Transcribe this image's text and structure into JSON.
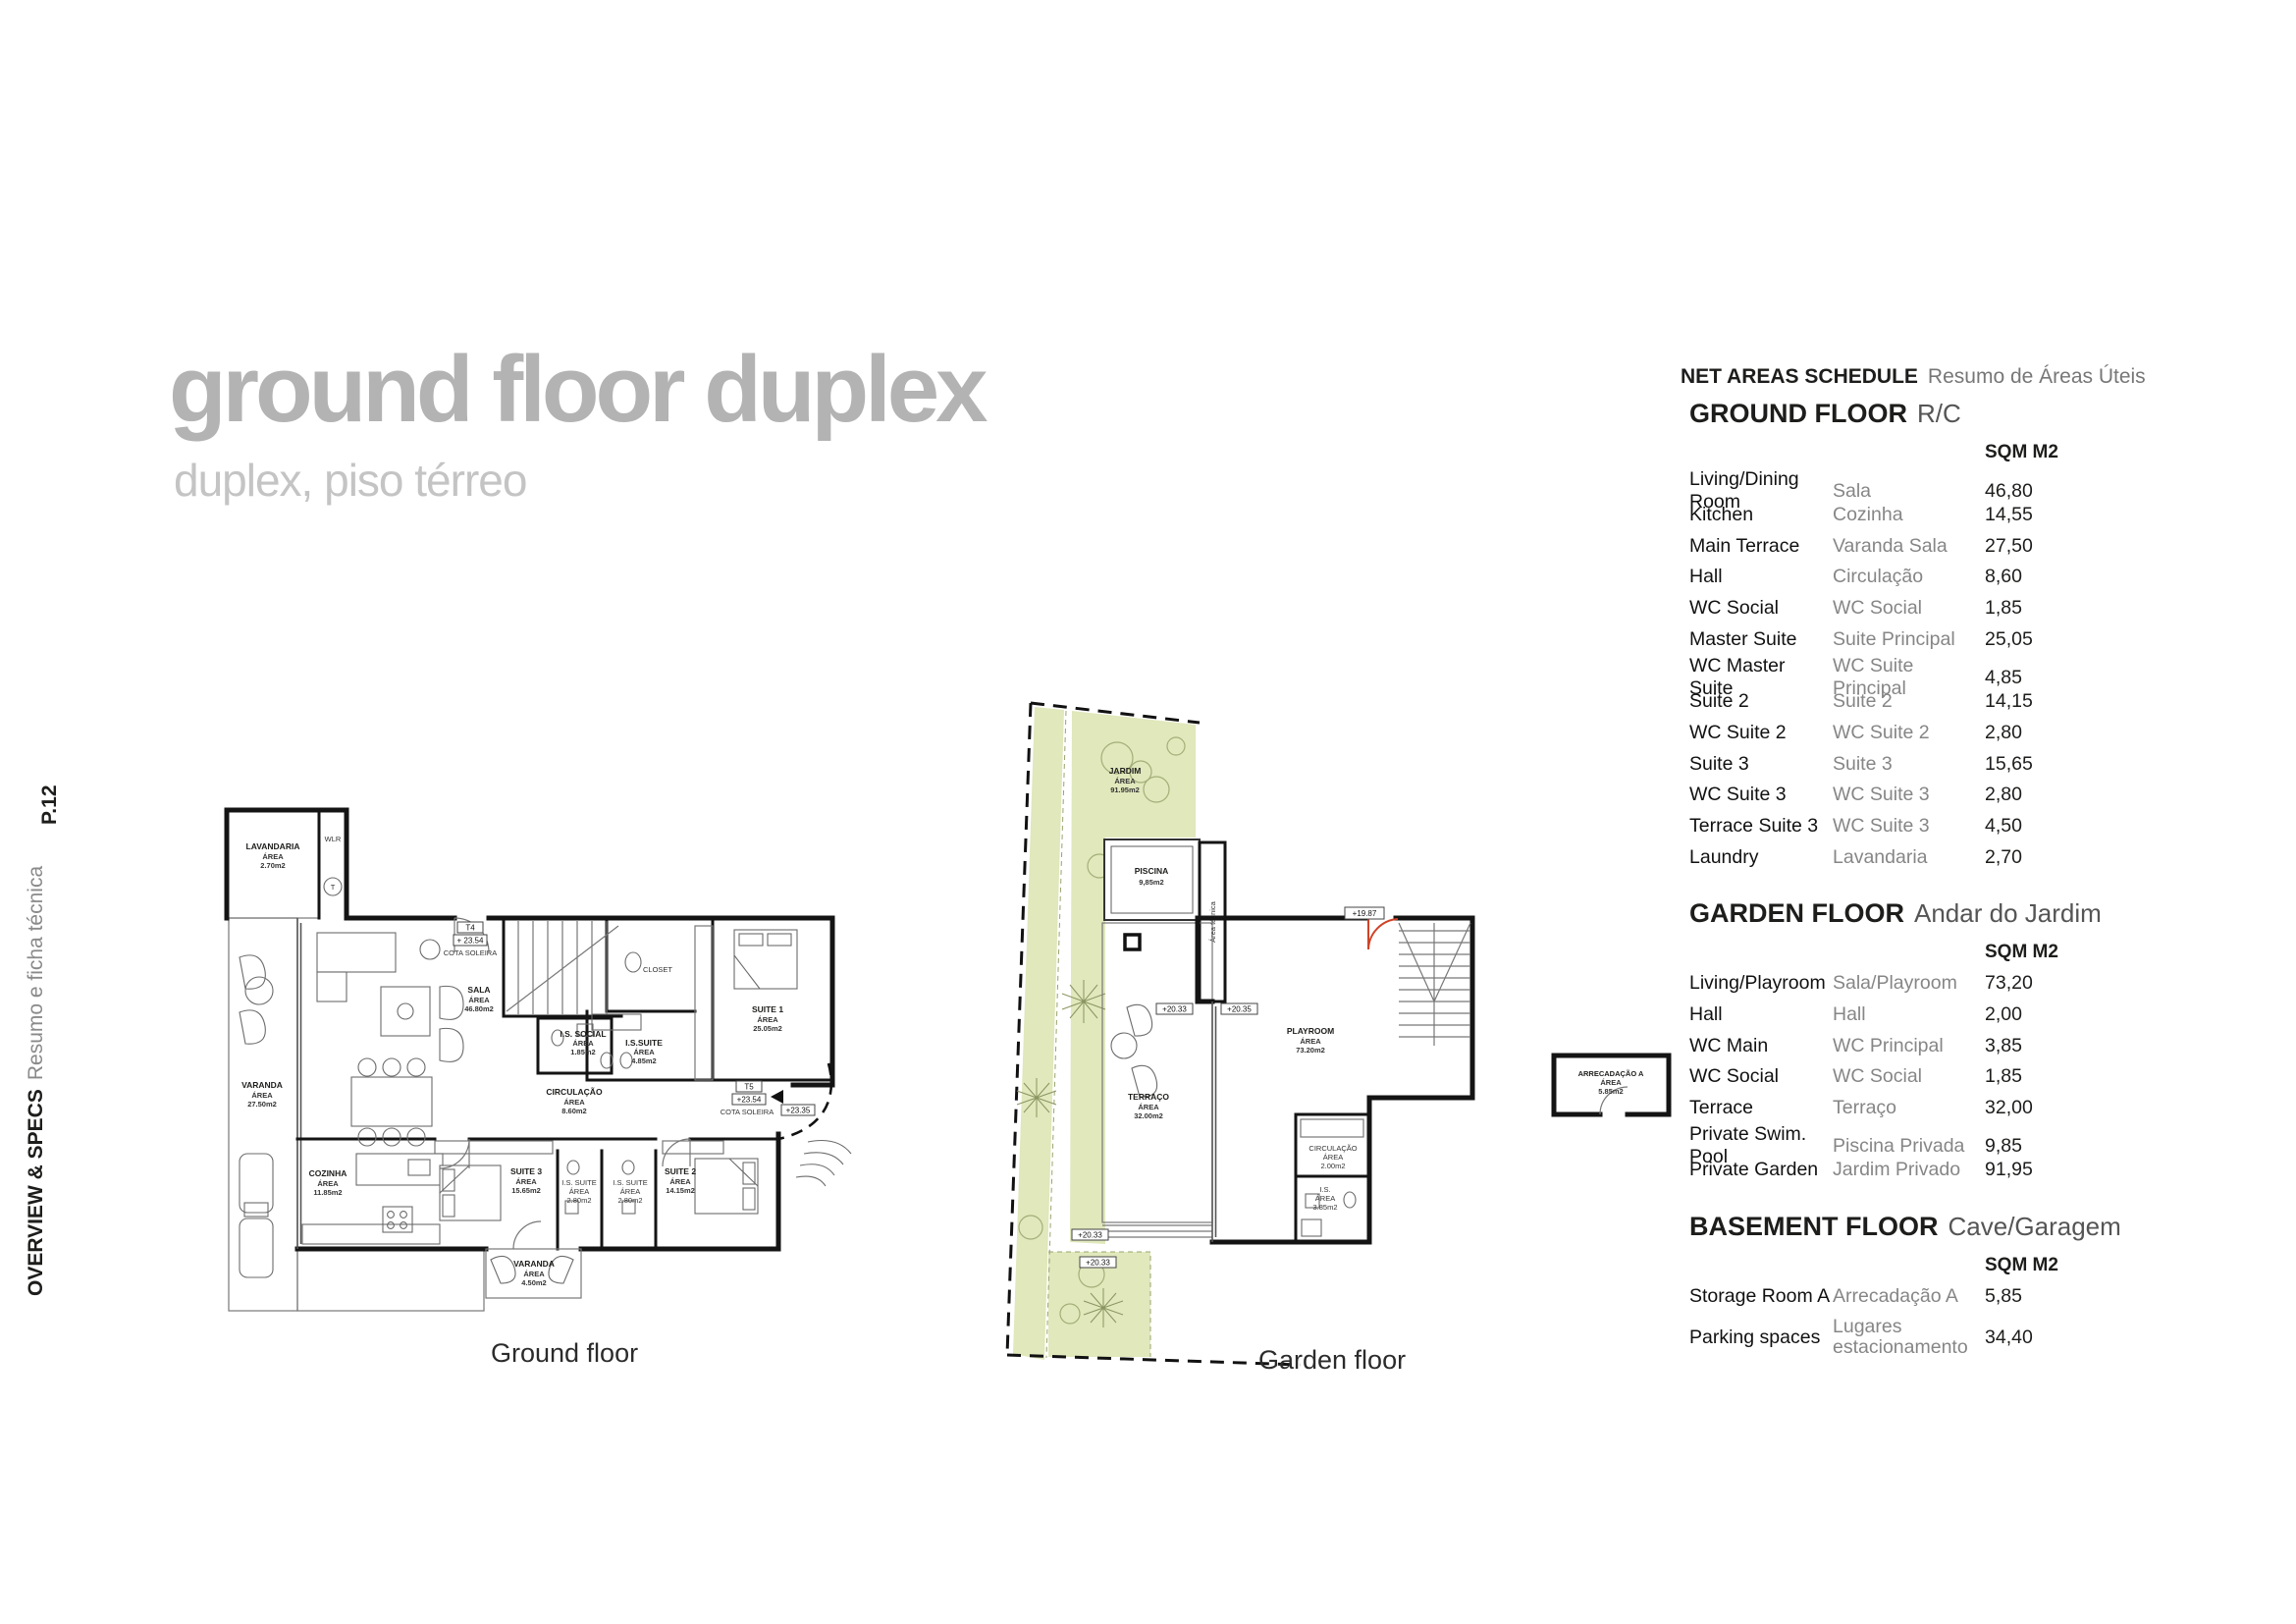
{
  "page": {
    "title": "ground floor duplex",
    "subtitle": "duplex, piso térreo",
    "page_number": "P.12",
    "sidebar_primary": "OVERVIEW & SPECS",
    "sidebar_secondary": "Resumo e ficha técnica"
  },
  "schedule": {
    "title_en": "NET AREAS SCHEDULE",
    "title_pt": "Resumo de Áreas Úteis",
    "sqm_header": "SQM M2",
    "sections": [
      {
        "heading_en": "GROUND FLOOR",
        "heading_pt": "R/C",
        "rows": [
          {
            "en": "Living/Dining Room",
            "pt": "Sala",
            "sqm": "46,80"
          },
          {
            "en": "Kitchen",
            "pt": "Cozinha",
            "sqm": "14,55"
          },
          {
            "en": "Main Terrace",
            "pt": "Varanda Sala",
            "sqm": "27,50"
          },
          {
            "en": "Hall",
            "pt": "Circulação",
            "sqm": "8,60"
          },
          {
            "en": "WC Social",
            "pt": "WC Social",
            "sqm": "1,85"
          },
          {
            "en": "Master Suite",
            "pt": "Suite Principal",
            "sqm": "25,05"
          },
          {
            "en": "WC Master Suite",
            "pt": "WC Suite Principal",
            "sqm": "4,85"
          },
          {
            "en": "Suite 2",
            "pt": "Suite 2",
            "sqm": "14,15"
          },
          {
            "en": "WC Suite 2",
            "pt": "WC Suite 2",
            "sqm": "2,80"
          },
          {
            "en": "Suite 3",
            "pt": "Suite 3",
            "sqm": "15,65"
          },
          {
            "en": "WC Suite 3",
            "pt": "WC Suite 3",
            "sqm": "2,80"
          },
          {
            "en": "Terrace Suite 3",
            "pt": "WC Suite 3",
            "sqm": "4,50"
          },
          {
            "en": "Laundry",
            "pt": "Lavandaria",
            "sqm": "2,70"
          }
        ]
      },
      {
        "heading_en": "GARDEN FLOOR",
        "heading_pt": "Andar do Jardim",
        "rows": [
          {
            "en": "Living/Playroom",
            "pt": "Sala/Playroom",
            "sqm": "73,20"
          },
          {
            "en": "Hall",
            "pt": "Hall",
            "sqm": "2,00"
          },
          {
            "en": "WC Main",
            "pt": "WC Principal",
            "sqm": "3,85"
          },
          {
            "en": "WC Social",
            "pt": "WC Social",
            "sqm": "1,85"
          },
          {
            "en": "Terrace",
            "pt": "Terraço",
            "sqm": "32,00"
          },
          {
            "en": "Private Swim. Pool",
            "pt": "Piscina Privada",
            "sqm": "9,85"
          },
          {
            "en": "Private Garden",
            "pt": "Jardim Privado",
            "sqm": "91,95"
          }
        ]
      },
      {
        "heading_en": "BASEMENT FLOOR",
        "heading_pt": "Cave/Garagem",
        "rows": [
          {
            "en": "Storage Room A",
            "pt": "Arrecadação A",
            "sqm": "5,85"
          },
          {
            "en": "Parking spaces",
            "pt": "Lugares estacionamento",
            "pt_line1": "Lugares",
            "pt_line2": "estacionamento",
            "sqm": "34,40"
          }
        ]
      }
    ]
  },
  "plans": {
    "ground": {
      "caption": "Ground floor",
      "rooms": {
        "lavandaria": {
          "name": "LAVANDARIA",
          "area_word": "ÁREA",
          "sqm": "2.70m2"
        },
        "wlr": {
          "name": "WLR"
        },
        "varanda": {
          "name": "VARANDA",
          "area_word": "ÁREA",
          "sqm": "27.50m2"
        },
        "sala": {
          "name": "SALA",
          "area_word": "ÁREA",
          "sqm": "46.80m2"
        },
        "cozinha": {
          "name": "COZINHA",
          "area_word": "ÁREA",
          "sqm": "11.85m2"
        },
        "is_social": {
          "name": "I.S. SOCIAL",
          "area_word": "ÁREA",
          "sqm": "1.85m2"
        },
        "circulacao": {
          "name": "CIRCULAÇÃO",
          "area_word": "ÁREA",
          "sqm": "8.60m2"
        },
        "closet": {
          "name": "CLOSET"
        },
        "is_suite": {
          "name": "I.S.SUITE",
          "area_word": "ÁREA",
          "sqm": "4.85m2"
        },
        "suite1": {
          "name": "SUITE 1",
          "area_word": "ÁREA",
          "sqm": "25.05m2"
        },
        "suite2": {
          "name": "SUITE 2",
          "area_word": "ÁREA",
          "sqm": "14.15m2"
        },
        "suite3": {
          "name": "SUITE 3",
          "area_word": "ÁREA",
          "sqm": "15.65m2"
        },
        "is_suite2": {
          "name": "I.S. SUITE",
          "area_word": "ÁREA",
          "sqm": "2.80m2"
        },
        "is_suite3": {
          "name": "I.S. SUITE",
          "area_word": "ÁREA",
          "sqm": "2.80m2"
        },
        "varanda_suite3": {
          "name": "VARANDA",
          "area_word": "ÁREA",
          "sqm": "4.50m2"
        }
      },
      "markers": {
        "t4": "T4",
        "t4_level": "+ 23.54",
        "t4_note": "COTA SOLEIRA",
        "t5": "T5",
        "t5_level": "+23.54",
        "t5_note": "COTA SOLEIRA",
        "entry_level": "+23.35",
        "laundry_circle": "T"
      }
    },
    "garden": {
      "caption": "Garden floor",
      "rooms": {
        "jardim": {
          "name": "JARDIM",
          "area_word": "ÁREA",
          "sqm": "91.95m2"
        },
        "piscina": {
          "name": "PISCINA",
          "sqm": "9,85m2"
        },
        "terraco": {
          "name": "TERRAÇO",
          "area_word": "ÁREA",
          "sqm": "32.00m2"
        },
        "playroom": {
          "name": "PLAYROOM",
          "area_word": "ÁREA",
          "sqm": "73.20m2"
        },
        "circulacao": {
          "name": "CIRCULAÇÃO",
          "area_word": "ÁREA",
          "sqm": "2.00m2"
        },
        "is": {
          "name": "I.S.",
          "area_word": "ÁREA",
          "sqm": "3.85m2"
        },
        "arrecadacao": {
          "name": "ARRECADAÇÃO A",
          "area_word": "ÁREA",
          "sqm": "5.85m2"
        },
        "area_tecnica": {
          "name": "Área técnica"
        }
      },
      "markers": {
        "terrace_level": "+20.33",
        "playroom_level": "+20.35",
        "lower_level": "+20.33",
        "garden_level": "+20.33",
        "door_level": "+19.87"
      }
    }
  }
}
